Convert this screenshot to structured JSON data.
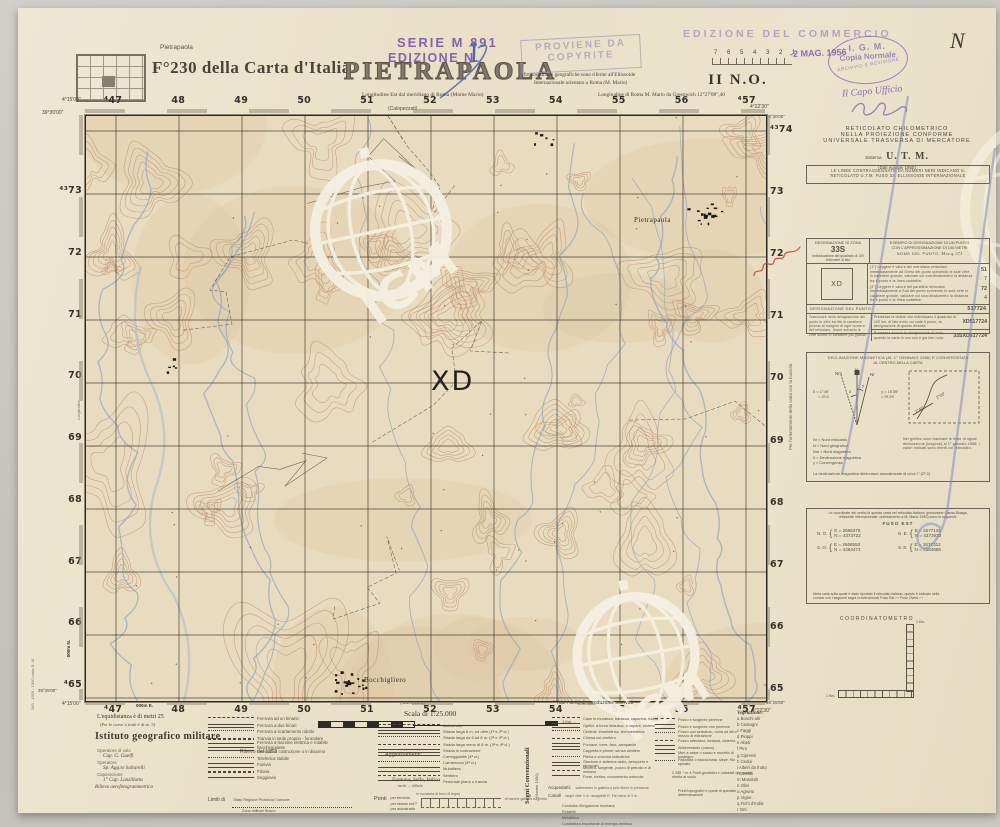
{
  "doc": {
    "locator_label": "Pietrapaola",
    "sheet_title": "F°230 della Carta d'Italia",
    "map_title": "PIETRAPAOLA",
    "quadrant": "II N.O.",
    "serie_stamp": "SERIE M 891",
    "edizione_stamp": "EDIZIONE N.",
    "edition_number": "1",
    "proviene_line1": "PROVIENE DA",
    "proviene_line2": "COPYRITE",
    "commercio_stamp": "EDIZIONE DEL COMMERCIO",
    "ruler_numbers": "7  6  5  4  3  2  1",
    "date_stamp": "-2 MAG. 1956",
    "oval_line1": "I. G. M.",
    "oval_line2": "Copia Normale",
    "oval_line3": "ARCHIVIO E REVISIONE",
    "capo_ufficio": "Il Capo Ufficio",
    "hand_n": "N",
    "long_note_left": "Longitudine Est dal meridiano di Roma (Monte Mario)",
    "coord_note1": "Le coordinate geografiche sono riferite all'Ellissoide",
    "coord_note2": "Internazionale orientato a Roma (M. Mario)",
    "long_note_right": "Longitudine di Roma M. Mario da Greenwich 12°27'08\",40"
  },
  "map": {
    "grid_top": [
      "⁴47",
      "48",
      "49",
      "50",
      "51",
      "52",
      "53",
      "54",
      "55",
      "56",
      "⁴57"
    ],
    "top_note": "(Calopezzati)",
    "grid_bottom": [
      "⁴47",
      "48",
      "49",
      "50",
      "51",
      "52",
      "53",
      "54",
      "55",
      "56",
      "⁴57"
    ],
    "bottom_note": "(Campana)",
    "grid_left": [
      "⁴³73",
      "72",
      "71",
      "70",
      "69",
      "68",
      "67",
      "66",
      "⁴65"
    ],
    "grid_right": [
      "⁴³74",
      "73",
      "72",
      "71",
      "70",
      "69",
      "68",
      "67",
      "66",
      "65"
    ],
    "suffix_e": "000m E.",
    "suffix_n": "000m N.",
    "tl_lon": "4°15'00\"",
    "tl_lat": "39°30'00\"",
    "tr_lon": "4°22'30\"",
    "tr_lat": "39°30'00\"",
    "bl_lon": "4°15'00\"",
    "bl_lat": "39°25'00\"",
    "br_lon": "4°22'30\"",
    "br_lat": "39°25'00\"",
    "square_label": "XD",
    "town1": "Pietrapaola",
    "town2": "Bocchigliero",
    "watermark": "IGM",
    "watermark_r": "®"
  },
  "margins": {
    "left_vert": "346 - 1956 - 1000 carta R. M.",
    "left_vert2": "Longitudine",
    "sidebar_vert": "Per l'orientamento della carta con la bussola"
  },
  "sidebar": {
    "utm_line1": "RETICOLATO  CHILOMETRICO",
    "utm_line2": "NELLA  PROIEZIONE  CONFORME",
    "utm_line3": "UNIVERSALE  TRASVERSA  DI  MERCATORE",
    "sistema_label": "Sistema",
    "sistema_value": "U. T. M.",
    "dati": "(Dati europei 1950)",
    "black_note1": "LE LINEE CONTRASSEGNATE DA NUMERI NERI INDICANO IL",
    "black_note2": "RETICOLATO U.T.M. FUSO 33. ELLISSOIDE INTERNAZIONALE",
    "zona": {
      "header": "DESIGNAZIONE DI ZONA",
      "value": "33S",
      "sub": "Individuazione del quadrato di 100 chilometri di lato",
      "ex_header1": "ESEMPIO DI DESIGNAZIONE DI UN PUNTO",
      "ex_header2": "CON L'APPROSSIMAZIONE DI 100 METRI",
      "nome_label": "NOME DEL PUNTO:",
      "nome_value": "M.te  q. 371",
      "square": "XD",
      "step1": "(1°) Leggere il valore del meridiano reticolato immediatamente ad Ovest del punto scrivendo le sole cifre in carattere grande; valutare col coordinatometro la distanza fra il punto e la linea suddetta:",
      "r1a": "51",
      "r1b": "7",
      "step2": "(2°) Leggere il valore del parallelo reticolato immediatamente a Sud del punto scrivendo le sole cifre in carattere grande; valutare col coordinatometro la distanza fra il punto e la linea suddetta:",
      "r2a": "72",
      "r2b": "4",
      "desig_label": "DESIGNAZIONE DEL PUNTO:",
      "desig_value": "517724",
      "note1": "Trascurare nella designazione del punto le cifre scritte in carattere piccolo al margine di ogni numero del reticolato. Usare soltanto le cifre scritte in carattere più grande.",
      "note2": "Premesse le lettere che individuano il quadrato di 100 km. di lato entro cui cade il punto, la designazione di questo diventa:",
      "v2": "XD517724",
      "note3": "Premessa ancora la designazione di zona, quando la carta in uso non è già ben nota:",
      "v3": "33SXD517724"
    },
    "decl": {
      "title1": "DECLINAZIONE MAGNETICA (AL 1° GENNAIO 1956) E CONVERGENZA",
      "title2": "AL CENTRO DELLA CARTA",
      "delta1": "δ = 1°49'",
      "delta2": "= 2ᵍ,0",
      "gamma1": "γ = 15'39\"",
      "gamma2": "= 0ᵍ,29",
      "nm": "Nm",
      "n": "N",
      "nr": "Nr",
      "legend1": "Nr  =  Nord reticolato",
      "legend2": "N   =  Nord geografico",
      "legend3": "Nm =  Nord magnetico",
      "legend4": "δ   =  Declinazione magnetica",
      "legend5": "γ   =  Convergenza",
      "chart_note": "Nel grafico sono tracciate le linee di ugual declinazione (isogone) al 1° gennaio 1956; i valori indicati sono riferiti col reticolato.",
      "iso1": "2°00'",
      "iso2": "1°45'",
      "annual": "La declinazione magnetica diminuisce annualmente di circa 7' (2ᶜ,2)"
    },
    "coords": {
      "intro1": "Le coordinate dei vertici di questa carta nel reticolato italiano (proiezione Gauss-Boaga,",
      "intro2": "ellissoide internazionale, orientamento a M. Mario 1940) sono le seguenti:",
      "fuso": "FUSO EST",
      "corners": [
        {
          "name": "N. O.",
          "e": "E = 2666375",
          "n": "N = 4373722"
        },
        {
          "name": "N. E.",
          "e": "E = 2677125",
          "n": "N = 4373933"
        },
        {
          "name": "S. O.",
          "e": "E = 2666550",
          "n": "N = 4364473"
        },
        {
          "name": "S. E.",
          "e": "E = 2677312",
          "n": "N = 4364686"
        }
      ],
      "note1": "Nella carta sulla quale è stato riportato il reticolato italiano, questo è indicato nella",
      "note2": "cornice con i seguenti segni convenzionali:   Fuso Est ⌐¬    Fuso Ovest ⌐¬"
    },
    "coordinatometro": "COORDINATOMETRO",
    "km_label": "1 Km."
  },
  "footer": {
    "rights": "Tutti i diritti di riproduzione riservati",
    "scala": "Scala di 1:25.000",
    "scale_right": "1 Km.",
    "equi1": "L'equidistanza è di metri 25",
    "equi2": "(Per le curve a tratti è di m. 5)",
    "igm": "Istituto geografico militare",
    "credits": {
      "c1": "Operatore di volo",
      "c2": "Cap. G. Guelfi",
      "c3": "Operatore",
      "c4": "Sp. Agg.to Saltarelli",
      "c5": "Caposezione",
      "c6": "1° Cap. Lanzillotta",
      "c7": "Rilievo aerofotogrammetrico",
      "rilievo": "Rilievo del 1953",
      "agg": "Aggiornamenti:"
    },
    "segni1": "Segni Convenzionali",
    "segni2": "(Norme 1950)",
    "col_rail": [
      "Ferrovia ad un binario",
      "Ferrovia a due binari",
      "Ferrovia a scartamento ridotto",
      "Tranvia in sede propria - funicolare",
      "Ferrovia a trazione elettrica e rotabile fiancheggiante",
      "Ferrovia in costruzione o in disarmo",
      "Teleferica stabile",
      "Funivia",
      "Filovia",
      "Seggiovia"
    ],
    "limiti_label": "Limiti di",
    "limiti_items1": "Stato      Regione      Provincia      Comune",
    "limiti_items2": "Zona militare        Bosco",
    "col_road": [
      "Autostrada",
      "Strada larga 8 m. ed oltre (1ª e 2ª cl.)",
      "Strada larga da 6 ad 8 m. (2ª e 3ª cl.)",
      "Strada larga meno di 6 m. (3ª e 4ª cl.)",
      "Strada in costruzione",
      "Carreggiabile (4ª cl.)",
      "Carrareccia (5ª cl.)",
      "Mulattiera",
      "Sentiero",
      "Pedonale piano o traccia"
    ],
    "road_caption": "Fontana, Sella, Valico",
    "road_caption2": "facile — difficile",
    "ponti_label": "Ponti",
    "ponti_cols": "in muratura     di ferro     di legno",
    "ponti_rows": [
      "per ferrovia",
      "per strada ord.ª",
      "per autostrada"
    ],
    "ponti_extra": "di barche     galleria     traghetto",
    "col_build": [
      "Case in muratura, baracca, capanna, ruderi",
      "Opifici: a forza idraulica, a vapore, elettrici",
      "Centrali: idroelettrica, termoelettrica",
      "Chiesa col cimitero",
      "Fornace, torre, faro, campanile",
      "Cappella e pilone; senza cimitero",
      "Pietra e colonna indicatrice",
      "Stazione e antenna radio; aeroporto e idroscalo",
      "Miniera, sorgente, pozzo di petrolio e di metano",
      "Forte, fortino; monumento notevole"
    ],
    "col_well": [
      "Pozzo e sorgente perenne",
      "Pozzo e sorgente non perenne",
      "Pozzo con serbatoio, noria od altro mezzo di estrazione",
      "Pozzo artesiano, fontana, cisterna",
      "Abbeveratoio (vasca)",
      "Muri a calce o sasso e muretto di sostegno",
      "Palizzata o staccionata, siepe, filo spinato"
    ],
    "acq_label": "Acquedotti:",
    "acq_caps": "sotterraneo      in galleria      a pelo libero      in pressione",
    "canali_label": "Canali",
    "canali_r1": "larghi oltre 3 m.      navigabile R. Fle      meno di 3 m.",
    "canali_r2": "Condotta d'irrigazione montana",
    "canali_r3": "Rotabile",
    "canali_r4": "Mulattiera",
    "canali_r5": "Conduttura importante di energia elettrica",
    "punti1": "2.335 ÷ m 4   Punti geodetici e catastali con quota riferita al suolo",
    "punti2": "Punti topografici e quote di speciale determinazione",
    "veg_title": "Vegetazione:",
    "vegetazione": [
      "a   Boschi alti",
      "b   Castagni",
      "c   Faggi",
      "d   Pioppi",
      "e   Abeti",
      "f   Pini",
      "g   Cipressi",
      "h   Cedui",
      "i   Alberi da frutto",
      "l   Cereali",
      "m   Mandorli",
      "n   Olivi",
      "o   Agrumi",
      "p   Vigne",
      "q   Fichi d'India",
      "r   Orti"
    ]
  }
}
